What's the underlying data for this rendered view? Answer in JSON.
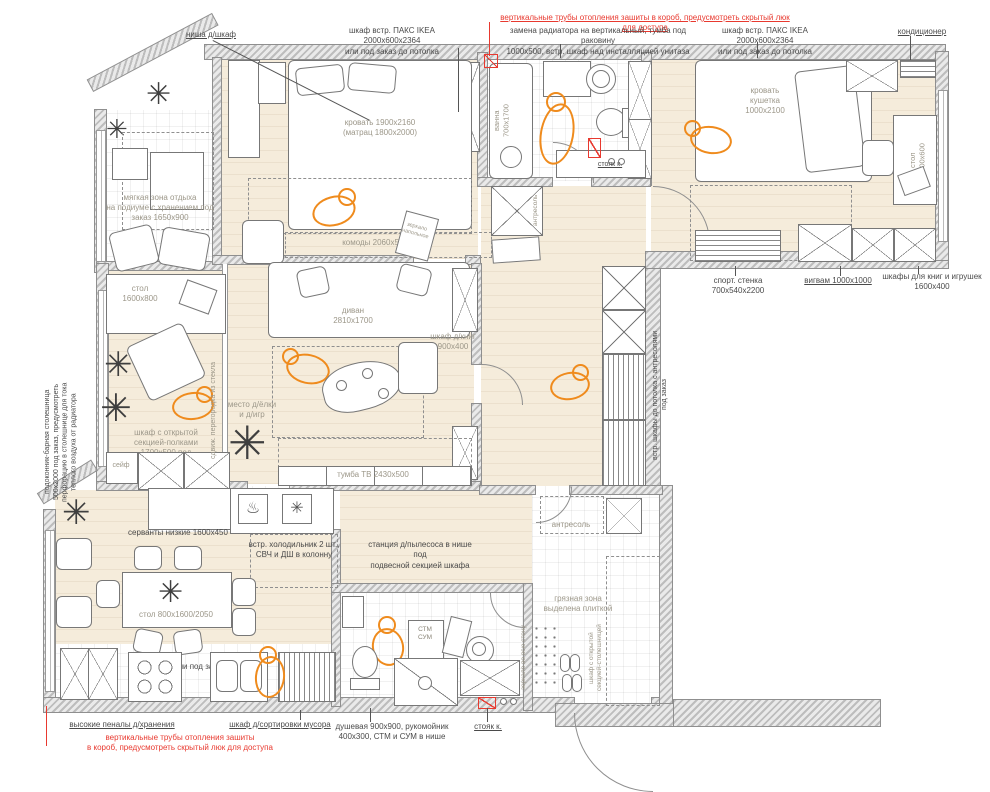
{
  "title": "план квартиры с расстановкой мебели",
  "colors": {
    "annotation_red": "#e8392f",
    "figure_orange": "#ef8b1d",
    "floor_beige": "#f5ecdb",
    "wall_hatch": "#bdbdbd"
  },
  "icons": {
    "plant": "✳",
    "oven": "♨",
    "hob": "✳"
  },
  "labels": {
    "top_red": "вертикальные трубы отопления зашиты в короб, предусмотреть скрытый люк для доступа",
    "niche": "ниша д/шкаф",
    "pax_left": "шкаф встр. ПАКС IKEA 2000х600х2364\nили под заказ до потолка",
    "radiator": "замена радиатора на вертикальный, тумба под раковину\n1000х500, встр. шкаф над инсталляцией унитаза",
    "pax_right": "шкаф встр. ПАКС IKEA 2000х600х2364\nили под заказ до потолка",
    "ac": "кондиционер",
    "soft_zone": "мягкая зона отдыха\nна подиуме с хранением под\nзаказ 1650х900",
    "bed": "кровать 1900х2160\n(матрац 1800х2000)",
    "dressers": "комоды 2060х500",
    "mirror_floor": "зеркало\nнапольное",
    "bath_tub": "ванна\n700х1700",
    "riser_top": "стояк к.",
    "mezz_top": "антресоль",
    "bed_couch": "кровать\nкушетка\n1000х2100",
    "desk_kids": "стол\n1600х600",
    "sport": "спорт. стенка\n700х540х2200",
    "wigwam": "вигвам 1000х1000",
    "bookcases": "шкафы для книг и игрушек\n1600х400",
    "desk_study": "стол\n1600х800",
    "open_shelf": "шкаф с открытой\nсекцией-полками\n1700х500 под\nзаказ",
    "safe": "сейф",
    "glass_partition": "сдвиж. перегородка из стекла",
    "windowsill": "подоконник-барная столешница\n500х2000 под заказ, предусмотреть\nперфорацию в столешнице для тока\nтеплого воздуха от радиатора",
    "sofa": "диван\n2810х1700",
    "bookcase_living": "шкаф д/книг\n900х400",
    "tree_spot": "место д/ёлки\nи д/игр",
    "tv": "тумба ТВ 2430х500",
    "builtin": "встр. шкафы до потолка с антресолями\nпод заказ",
    "sideboards": "серванты низкие 1600х450",
    "dining_table": "стол 800х1600/2050",
    "kitchen_label": "кухня Икея или под заказ",
    "fridge": "встр. холодильник 2 шт.,\nСВЧ и ДШ в колонну",
    "vacuum": "станция д/пылесоса в нише под\nподвесной секцией шкафа",
    "dirty_zone": "грязная зона\nвыделена плиткой",
    "stm_sum": "СТМ\nСУМ",
    "mirror_wall": "зеркало во всю стену",
    "open_counter": "шкаф с открытой\nсекцией-столешницей",
    "mezz_hall": "антресоль",
    "tall_cabinets": "высокие пеналы д/хранения",
    "bottom_red": "вертикальные трубы отопления зашиты\nв короб, предусмотреть скрытый люк для доступа",
    "trash": "шкаф д/сортировки мусора",
    "shower": "душевая 900х900, рукомойник\n400х300, СТМ и СУМ в нише",
    "riser_bottom": "стояк к."
  }
}
